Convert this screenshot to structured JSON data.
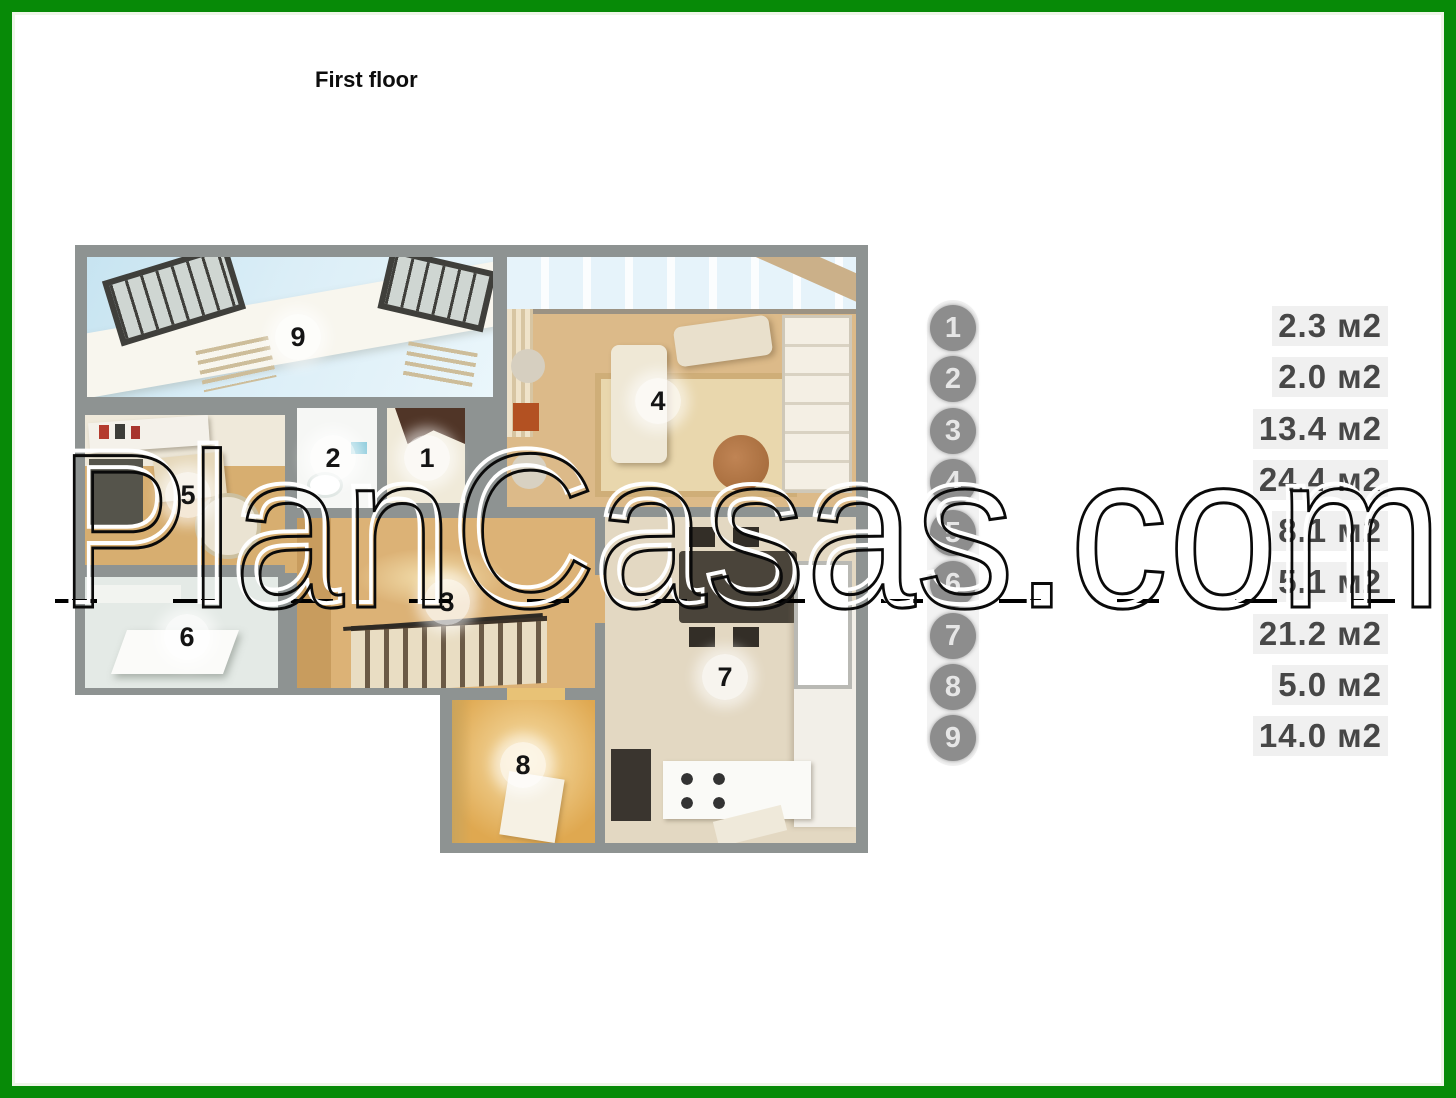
{
  "page": {
    "title": "First floor"
  },
  "watermark": {
    "text": "PlanCasas.com"
  },
  "floor_plan": {
    "rooms": [
      {
        "number": "1"
      },
      {
        "number": "2"
      },
      {
        "number": "3"
      },
      {
        "number": "4"
      },
      {
        "number": "5"
      },
      {
        "number": "6"
      },
      {
        "number": "7"
      },
      {
        "number": "8"
      },
      {
        "number": "9"
      }
    ]
  },
  "legend": {
    "items": [
      {
        "number": "1",
        "area": "2.3 м2"
      },
      {
        "number": "2",
        "area": "2.0 м2"
      },
      {
        "number": "3",
        "area": "13.4 м2"
      },
      {
        "number": "4",
        "area": "24.4 м2"
      },
      {
        "number": "5",
        "area": "8.1 м2"
      },
      {
        "number": "6",
        "area": "5.1 м2"
      },
      {
        "number": "7",
        "area": "21.2 м2"
      },
      {
        "number": "8",
        "area": "5.0 м2"
      },
      {
        "number": "9",
        "area": "14.0 м2"
      }
    ]
  },
  "colors": {
    "border_green": "#078a07",
    "wall_gray": "#8e9392",
    "legend_circle_gray": "#8d8d8d",
    "sky_blue": "#d6ecf6",
    "wood_tan": "#d9b57e"
  }
}
